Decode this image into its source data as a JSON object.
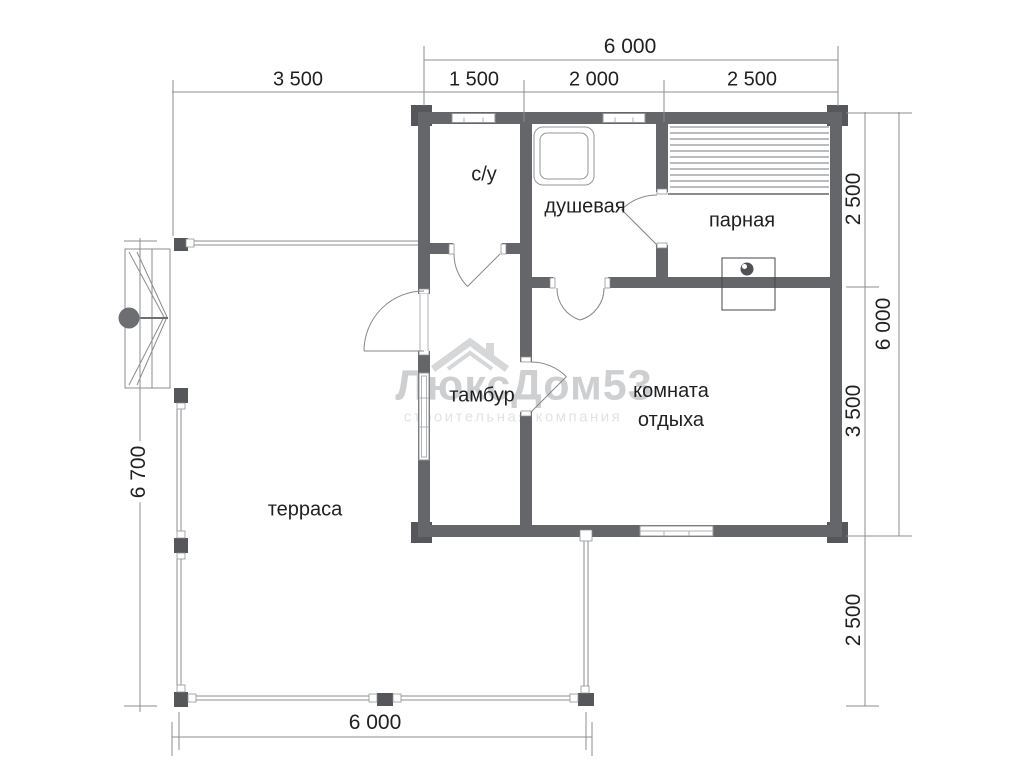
{
  "plan": {
    "title": "bathhouse-floor-plan",
    "rooms": [
      {
        "id": "su",
        "label": "с/у"
      },
      {
        "id": "shower",
        "label": "душевая"
      },
      {
        "id": "steam",
        "label": "парная"
      },
      {
        "id": "tambour",
        "label": "тамбур"
      },
      {
        "id": "rest",
        "label": "комната отдыха",
        "line1": "комната",
        "line2": "отдыха"
      },
      {
        "id": "terrace",
        "label": "терраса"
      }
    ],
    "dimensions": {
      "top_total": "6 000",
      "top_segments": [
        "3 500",
        "1 500",
        "2 000",
        "2 500"
      ],
      "right_segments": [
        "2 500",
        "3 500",
        "2 500"
      ],
      "right_total": "6 000",
      "left_total": "6 700",
      "bottom_total": "6 000"
    },
    "watermark": {
      "brand": "ЛюксДом53",
      "subtitle": "строительная компания"
    },
    "colors": {
      "wall": "#656669",
      "corner_block": "#56575a",
      "thin_line": "#8a8c8f",
      "text": "#1f2022",
      "watermark": "#cdcfd1"
    }
  }
}
